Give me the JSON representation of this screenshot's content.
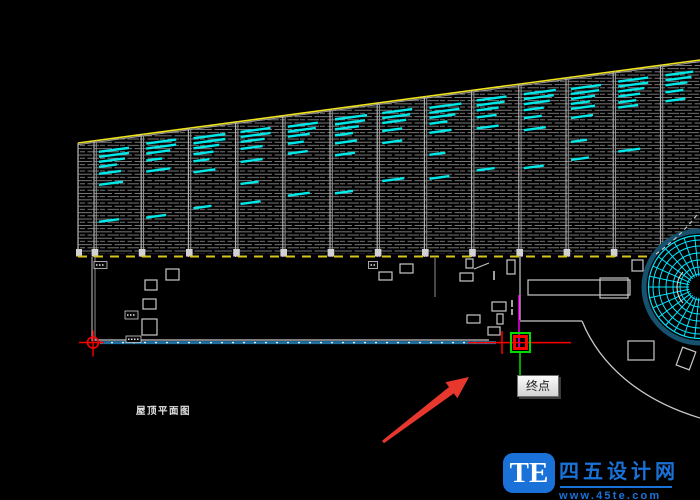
{
  "app": {
    "bg": "#000000",
    "width": 700,
    "height": 500
  },
  "labels": {
    "roof_plan": "屋顶平面图"
  },
  "snap": {
    "tooltip": "终点"
  },
  "watermark": {
    "logo": "TE",
    "site_name": "四五设计网",
    "url": "www.45te.com",
    "accent": "#1a72d8"
  },
  "colors": {
    "hatch": "#8a8a8a",
    "divider": "#b9b9b9",
    "divider2": "#8f8f8f",
    "top_edge": "#f2e41c",
    "bottom_edge": "#d9c41e",
    "cyan": "#00e8e8",
    "white_line": "#c8c8c8",
    "track_blue": "#1f6f9f",
    "track_dash": "#dff0ff",
    "magenta": "#ff00ff",
    "green": "#00dc00",
    "red": "#ff0000",
    "fan_outline": "#16516e",
    "fan_grid": "#00e5ff",
    "arrow_red": "#e8382e",
    "base_block": "#d2d2d2"
  },
  "drawing": {
    "band": {
      "x1": 78,
      "y1_top": 143,
      "x2": 700,
      "y2_top": 60,
      "y_bottom": 254,
      "dash_y": 256.5
    },
    "slope": 0.13344,
    "divider_xs": [
      94,
      141.2,
      188.4,
      235.6,
      282.8,
      330,
      377.2,
      424.4,
      471.6,
      518.8,
      566,
      613.2,
      660.4
    ],
    "cyan_columns": [
      {
        "x": 94,
        "lines": [
          [
            11,
            30
          ],
          [
            16,
            30
          ],
          [
            21,
            26
          ],
          [
            26,
            18
          ],
          [
            33,
            22
          ],
          [
            44,
            24
          ],
          [
            81,
            20
          ]
        ]
      },
      {
        "x": 141.2,
        "lines": [
          [
            9,
            30
          ],
          [
            14,
            30
          ],
          [
            19,
            24
          ],
          [
            26,
            16
          ],
          [
            37,
            24
          ],
          [
            83,
            20
          ]
        ]
      },
      {
        "x": 188.4,
        "lines": [
          [
            10,
            32
          ],
          [
            15,
            32
          ],
          [
            20,
            26
          ],
          [
            26,
            20
          ],
          [
            33,
            16
          ],
          [
            44,
            22
          ],
          [
            80,
            18
          ]
        ]
      },
      {
        "x": 235.6,
        "lines": [
          [
            10,
            30
          ],
          [
            15,
            30
          ],
          [
            20,
            24
          ],
          [
            27,
            22
          ],
          [
            40,
            22
          ],
          [
            62,
            18
          ],
          [
            82,
            20
          ]
        ]
      },
      {
        "x": 282.8,
        "lines": [
          [
            11,
            30
          ],
          [
            16,
            28
          ],
          [
            21,
            22
          ],
          [
            28,
            16
          ],
          [
            38,
            20
          ],
          [
            80,
            22
          ]
        ]
      },
      {
        "x": 330,
        "lines": [
          [
            10,
            32
          ],
          [
            15,
            30
          ],
          [
            20,
            24
          ],
          [
            26,
            18
          ],
          [
            34,
            22
          ],
          [
            46,
            20
          ],
          [
            84,
            18
          ]
        ]
      },
      {
        "x": 377.2,
        "lines": [
          [
            10,
            30
          ],
          [
            15,
            28
          ],
          [
            20,
            24
          ],
          [
            28,
            20
          ],
          [
            40,
            20
          ],
          [
            78,
            22
          ]
        ]
      },
      {
        "x": 424.4,
        "lines": [
          [
            11,
            32
          ],
          [
            16,
            30
          ],
          [
            21,
            26
          ],
          [
            27,
            18
          ],
          [
            36,
            22
          ],
          [
            58,
            16
          ],
          [
            82,
            20
          ]
        ]
      },
      {
        "x": 471.6,
        "lines": [
          [
            10,
            30
          ],
          [
            15,
            28
          ],
          [
            20,
            22
          ],
          [
            27,
            20
          ],
          [
            38,
            22
          ],
          [
            80,
            18
          ]
        ]
      },
      {
        "x": 518.8,
        "lines": [
          [
            10,
            32
          ],
          [
            15,
            30
          ],
          [
            20,
            26
          ],
          [
            26,
            20
          ],
          [
            34,
            18
          ],
          [
            46,
            22
          ],
          [
            84,
            20
          ]
        ]
      },
      {
        "x": 566,
        "lines": [
          [
            11,
            30
          ],
          [
            16,
            28
          ],
          [
            21,
            24
          ],
          [
            26,
            19
          ],
          [
            31,
            24
          ],
          [
            40,
            22
          ],
          [
            64,
            16
          ],
          [
            82,
            18
          ]
        ]
      },
      {
        "x": 613.2,
        "lines": [
          [
            10,
            30
          ],
          [
            15,
            30
          ],
          [
            20,
            26
          ],
          [
            25,
            22
          ],
          [
            31,
            18
          ],
          [
            36,
            20
          ],
          [
            80,
            22
          ]
        ]
      },
      {
        "x": 660.4,
        "lines": [
          [
            10,
            28
          ],
          [
            15,
            26
          ],
          [
            20,
            22
          ],
          [
            27,
            18
          ],
          [
            36,
            20
          ]
        ]
      }
    ],
    "plan_rects": [
      [
        166,
        269,
        13,
        11,
        0
      ],
      [
        145,
        280,
        12,
        10,
        0
      ],
      [
        143,
        299,
        13,
        10,
        0
      ],
      [
        142,
        319,
        15,
        16,
        0
      ],
      [
        370,
        262,
        7,
        6,
        0
      ],
      [
        379,
        272,
        13,
        8,
        0
      ],
      [
        400,
        264,
        13,
        9,
        0
      ],
      [
        460,
        273,
        13,
        8,
        0
      ],
      [
        466,
        259,
        7,
        9,
        0
      ],
      [
        507,
        260,
        8,
        14,
        0
      ],
      [
        492,
        302,
        14,
        9,
        0
      ],
      [
        467,
        315,
        13,
        8,
        0
      ],
      [
        497,
        314,
        6,
        10,
        0
      ],
      [
        488,
        327,
        12,
        8,
        0
      ],
      [
        528,
        280,
        102,
        15,
        0
      ],
      [
        600,
        278,
        28,
        20,
        0
      ],
      [
        632,
        260,
        11,
        11,
        0
      ],
      [
        628,
        341,
        26,
        19,
        0
      ],
      [
        679,
        349,
        14,
        19,
        20
      ]
    ],
    "dim_labels": [
      [
        94,
        261.5,
        13,
        7
      ],
      [
        368.5,
        261.5,
        9,
        7
      ],
      [
        125,
        311,
        13,
        8
      ],
      [
        126,
        336,
        15,
        6.5
      ]
    ],
    "plan_lines": [
      [
        92,
        257,
        92,
        341,
        "white_line",
        1,
        ""
      ],
      [
        95,
        257,
        95,
        341,
        "divider2",
        1,
        ""
      ],
      [
        95,
        340,
        489,
        340,
        "white_line",
        1.2,
        ""
      ],
      [
        100,
        342.6,
        496,
        342.6,
        "track_blue",
        3,
        ""
      ],
      [
        100,
        342.6,
        496,
        342.6,
        "track_dash",
        1.4,
        "2 9"
      ],
      [
        435,
        258,
        435,
        297,
        "divider2",
        1,
        ""
      ],
      [
        474,
        269,
        489,
        263,
        "white_line",
        1,
        ""
      ],
      [
        520,
        257,
        520,
        320,
        "white_line",
        1.2,
        ""
      ],
      [
        520,
        321,
        582,
        321,
        "white_line",
        1.3,
        ""
      ],
      [
        519,
        295,
        519,
        347,
        "magenta",
        1.4,
        ""
      ],
      [
        520,
        353,
        520,
        376,
        "green",
        1.5,
        ""
      ],
      [
        468,
        342.6,
        571,
        342.6,
        "red",
        1.5,
        ""
      ],
      [
        502,
        331,
        502,
        354,
        "red",
        1.5,
        ""
      ],
      [
        494,
        271,
        494,
        280,
        "white_line",
        1.6,
        ""
      ],
      [
        512,
        300,
        512,
        307,
        "white_line",
        1.6,
        ""
      ],
      [
        512,
        309,
        512,
        315,
        "white_line",
        1.6,
        ""
      ]
    ],
    "curves": [
      {
        "d": "M582,321 C600,365 640,400 700,418",
        "color": "white_line",
        "w": 1.3,
        "dash": ""
      },
      {
        "d": "M656,254 C670,244 686,230 699,212",
        "color": "white_line",
        "w": 1.2,
        "dash": "4 3.5"
      }
    ],
    "fan": {
      "cx": 700,
      "cy": 287,
      "r": 56,
      "ring_r": 51.5,
      "rings": [
        13,
        20,
        27,
        34,
        41,
        47
      ],
      "spoke_step": 12,
      "inner_r": 11,
      "white_arc": "M683,272 A23,23 0 0 0 683,303"
    },
    "datum": {
      "cx": 93,
      "cy": 342.5,
      "r": 5.5,
      "arm": 14
    },
    "snap_box": {
      "x": 511,
      "y": 333,
      "size": 19,
      "inner_inset": 3.5,
      "inner_w": 3
    },
    "arrow": {
      "points": "469,377 445.4,382.2 449,387 382.1,440.8 383.9,443.2 453.8,393.4 457.4,398.2"
    }
  }
}
